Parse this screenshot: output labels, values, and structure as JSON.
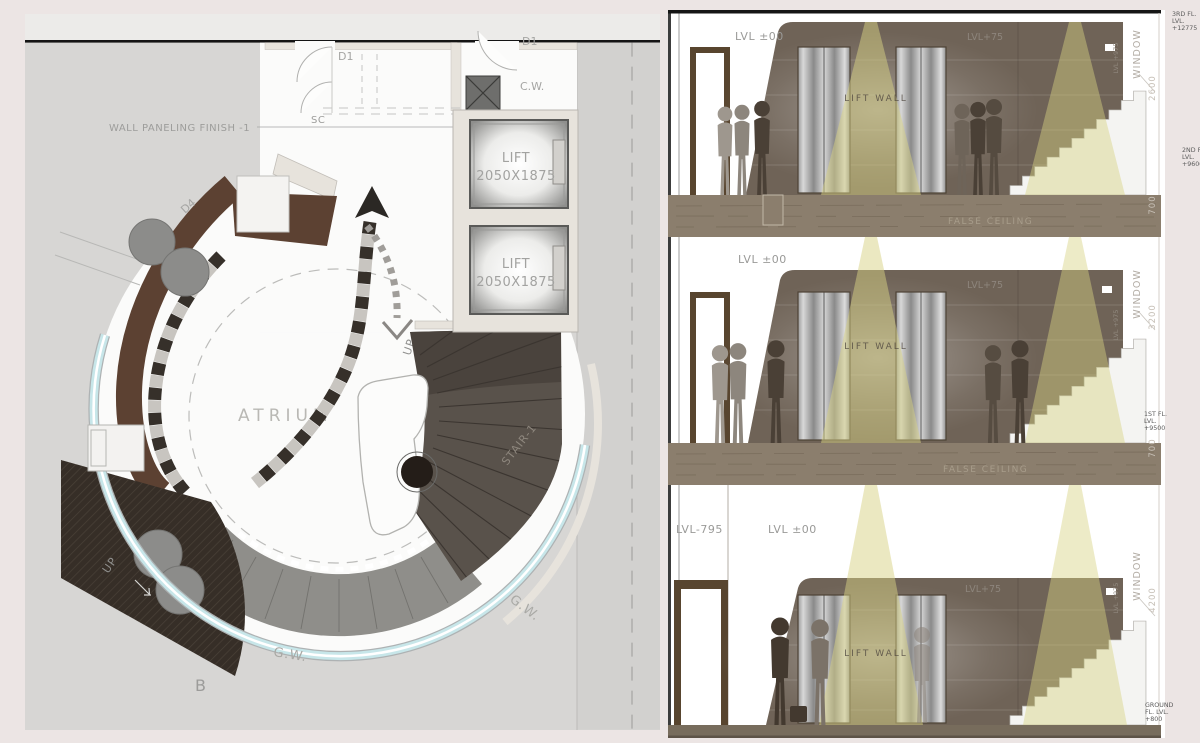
{
  "plan": {
    "wall_paneling_label": "WALL PANELING FINISH -1",
    "sc_label": "SC",
    "door_label_left": "D1",
    "door_label_right": "D1",
    "door_label_d4": "D4",
    "cw_label_top": "C.W.",
    "lift_label": "LIFT",
    "lift_size": "2050X1875",
    "atrium_label": "ATRIUM",
    "up_label_stair": "UP",
    "up_label_ramp": "UP",
    "stair_label": "STAIR-1",
    "gw_label_right": "G.W.",
    "gw_label_bottom": "G.W.",
    "b_label": "B"
  },
  "elevation": {
    "s1": {
      "lvl_zero": "LVL ±00",
      "lvl_75": "LVL+75",
      "lift_wall": "LIFT WALL",
      "window": "WINDOW",
      "sill": "LVL +975"
    },
    "s2": {
      "lvl_zero": "LVL ±00",
      "lvl_75": "LVL+75",
      "lift_wall": "LIFT WALL",
      "window": "WINDOW",
      "sill": "LVL +975"
    },
    "s3": {
      "lvl_neg": "LVL-795",
      "lvl_zero": "LVL ±00",
      "lvl_75": "LVL+75",
      "lift_wall": "LIFT WALL",
      "window": "WINDOW",
      "sill": "LVL +975"
    },
    "false_ceiling_1": "FALSE CEILING",
    "false_ceiling_2": "FALSE CEILING",
    "dim_2600": "2600",
    "dim_700a": "700",
    "dim_3200": "3200",
    "dim_700b": "700",
    "dim_4200": "4200",
    "level_3": "3RD FL.\nLVL.\n+12775",
    "level_2": "2ND FL.\nLVL.\n+9600",
    "level_1": "1ST FL.\nLVL.\n+9500",
    "level_g": "GROUND\nFL. LVL.\n+800"
  },
  "colors": {
    "page_bg": "#ece5e4",
    "plan_bg": "#d7d6d4",
    "glass": "#c7e6e9",
    "wall_brown": "#6f6357",
    "paneling_brown": "#5c4132",
    "cone": "#d8d283",
    "slab": "#8b7e6d"
  }
}
